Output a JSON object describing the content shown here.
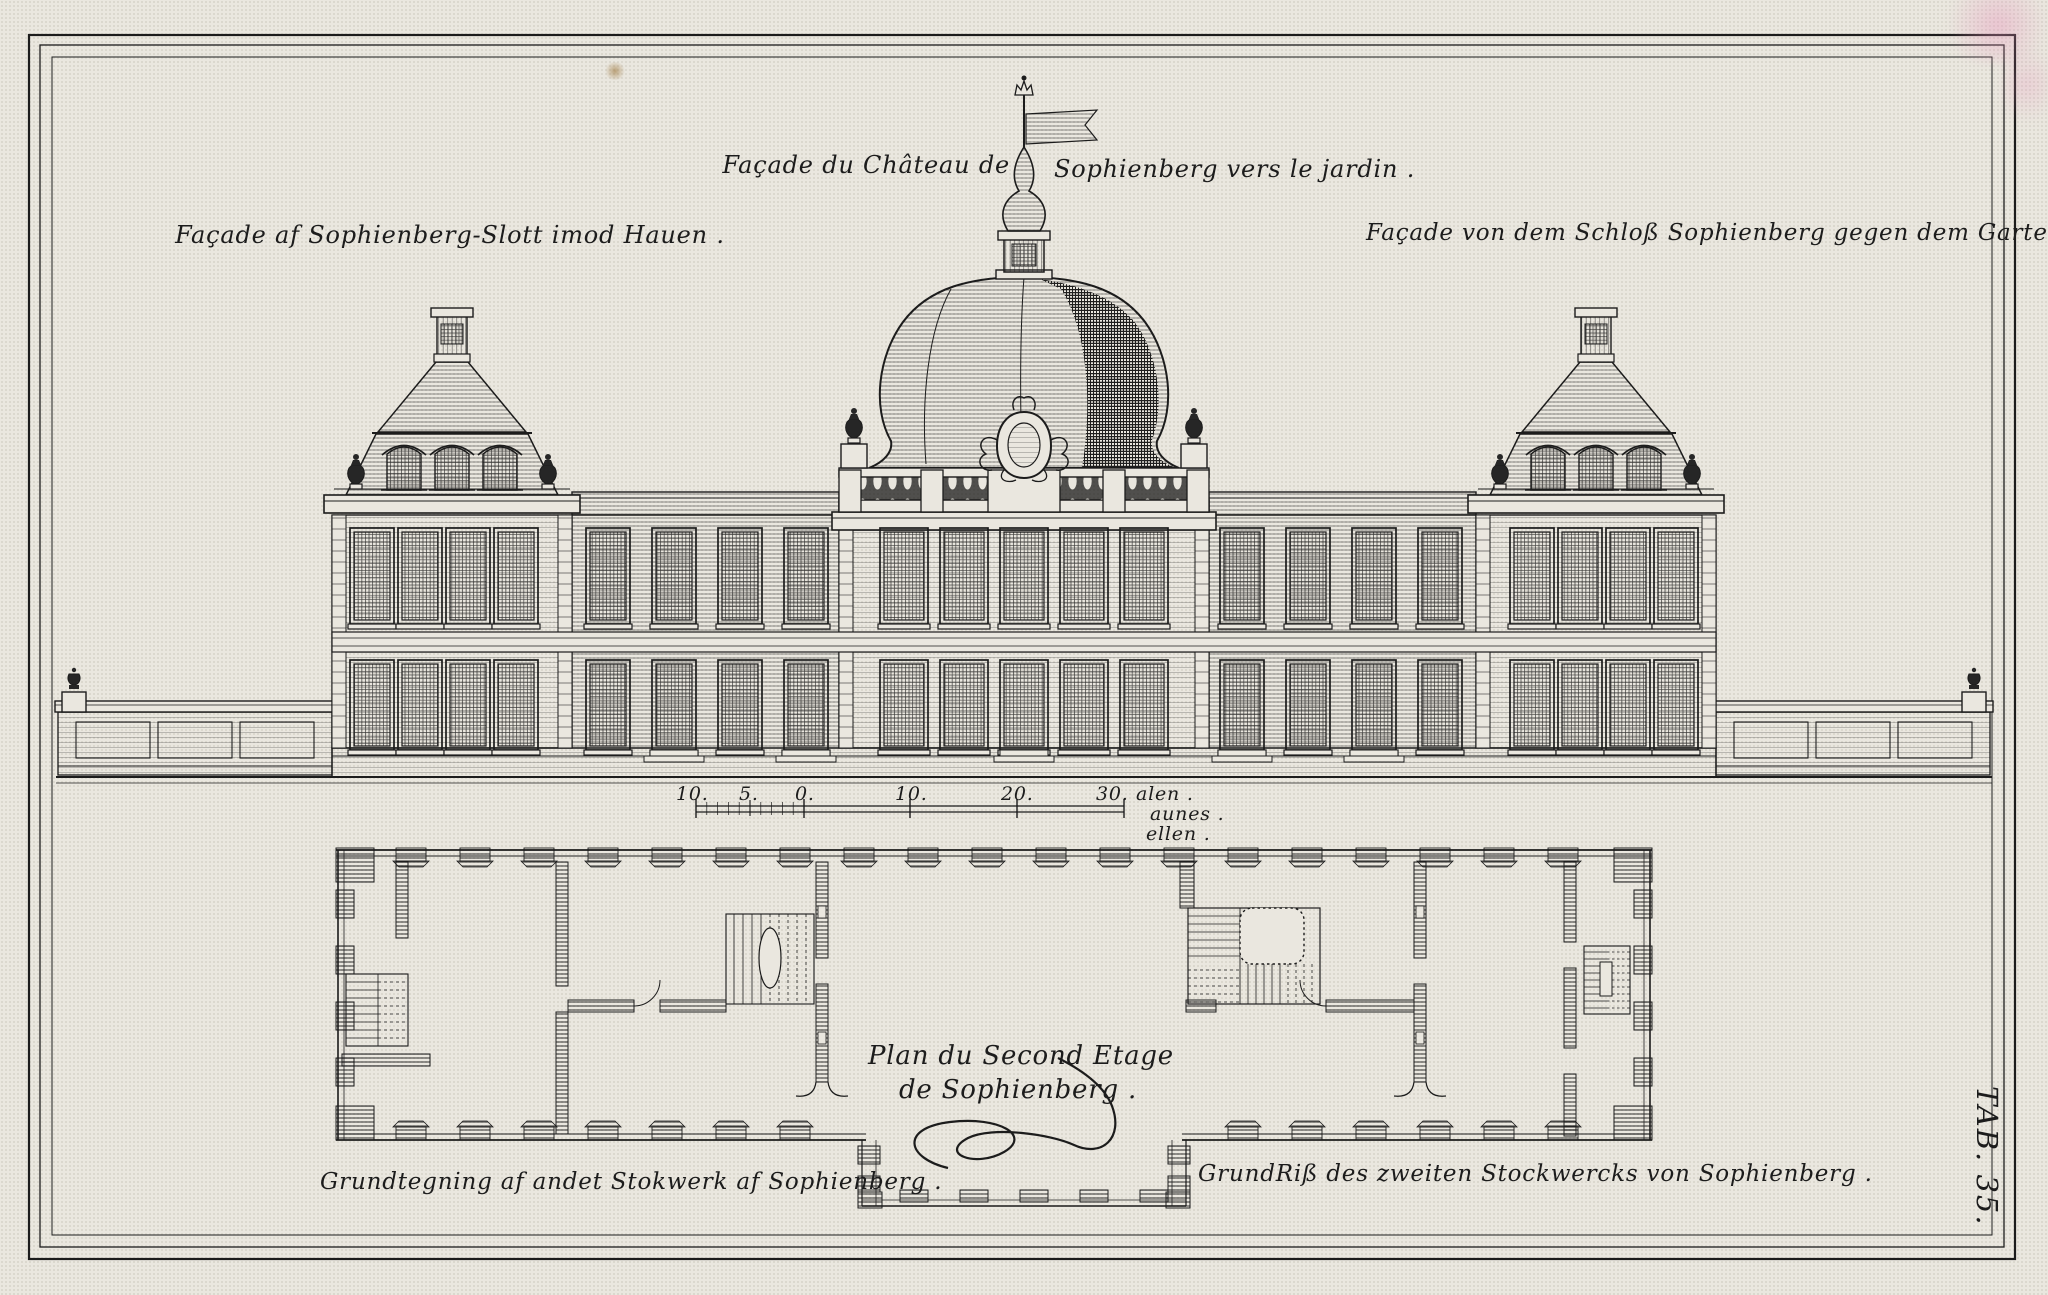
{
  "plate": {
    "titles": {
      "danish": "Façade af Sophienberg-Slott imod Hauen .",
      "french_part1": "Façade du Château de",
      "french_part2": "Sophienberg vers le jardin .",
      "german": "Façade von dem Schloß Sophienberg gegen dem Garten ."
    },
    "scale_bar": {
      "tick_labels": [
        "10.",
        "5.",
        "0.",
        "10.",
        "20.",
        "30."
      ],
      "unit_labels": [
        "alen .",
        "aunes .",
        "ellen ."
      ]
    },
    "plan": {
      "title_line1": "Plan du Second Etage",
      "title_line2": "de Sophienberg .",
      "caption_danish": "Grundtegning af andet Stokwerk af Sophienberg .",
      "caption_german": "GrundRiß des zweiten Stockwercks von Sophienberg ."
    },
    "tab_label": "TAB. 35.",
    "colors": {
      "paper": "#eae7df",
      "ink": "#1c1c1c"
    }
  }
}
